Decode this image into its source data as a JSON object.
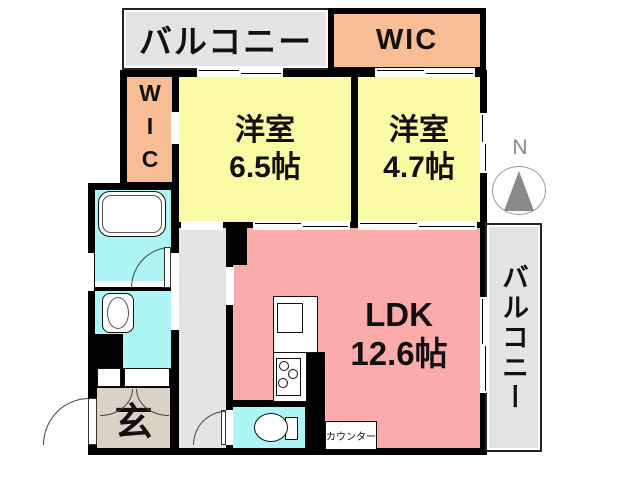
{
  "plan": {
    "title": "apartment-floor-plan",
    "balcony_top": "バルコニー",
    "balcony_right": "バルコニー",
    "wic_top": "WIC",
    "wic_left": "WIC",
    "rooms": {
      "bedroom1": {
        "name": "洋室",
        "size": "6.5帖"
      },
      "bedroom2": {
        "name": "洋室",
        "size": "4.7帖"
      },
      "ldk": {
        "name": "LDK",
        "size": "12.6帖"
      },
      "entrance": "玄",
      "counter": "カウンター"
    },
    "compass": {
      "north": "N"
    },
    "colors": {
      "wall": "#000000",
      "bedroom": "#fbfba6",
      "wic": "#f9bd96",
      "ldk": "#fcabab",
      "wet": "#aef6f6",
      "balcony": "#e4e4e4",
      "hallway": "#e4e4e4",
      "genkan": "#d7d3c5",
      "compass_gray": "#8a8a8a"
    }
  }
}
